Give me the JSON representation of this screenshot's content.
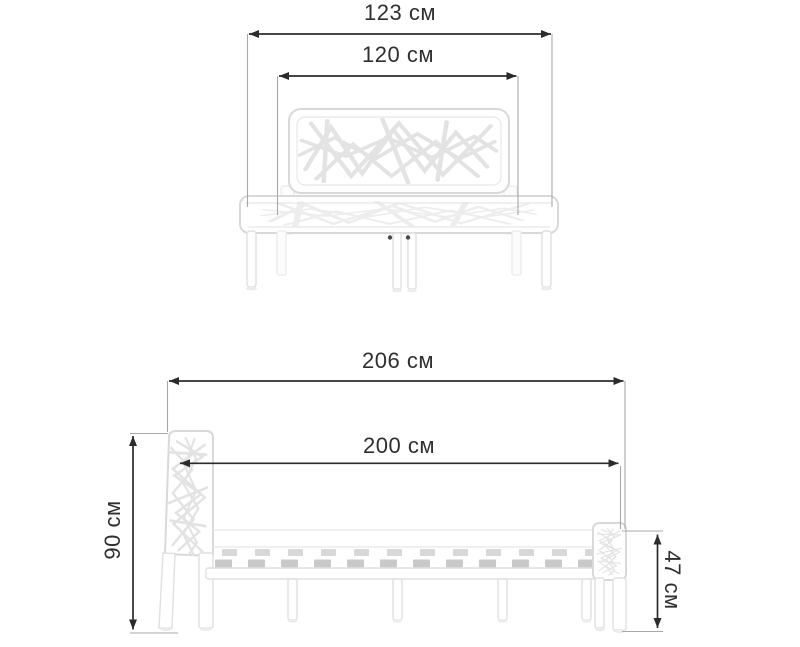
{
  "diagram": {
    "unit": "см",
    "views": {
      "front": {
        "dimensions": {
          "overall_width": {
            "value": 123,
            "label": "123 см"
          },
          "mattress_width": {
            "value": 120,
            "label": "120 см"
          }
        }
      },
      "side": {
        "dimensions": {
          "overall_length": {
            "value": 206,
            "label": "206 см"
          },
          "mattress_length": {
            "value": 200,
            "label": "200 см"
          },
          "headboard_height": {
            "value": 90,
            "label": "90 см"
          },
          "footboard_height": {
            "value": 47,
            "label": "47 см"
          }
        }
      }
    },
    "colors": {
      "background": "#ffffff",
      "dimension_line": "#2b2b2b",
      "extension_line": "#a8a8a8",
      "label_text": "#2f2f2f",
      "bed_outline": "#d9d9d9",
      "bed_pattern": "#e3e3e3",
      "slat": "#c9c9c9"
    }
  }
}
